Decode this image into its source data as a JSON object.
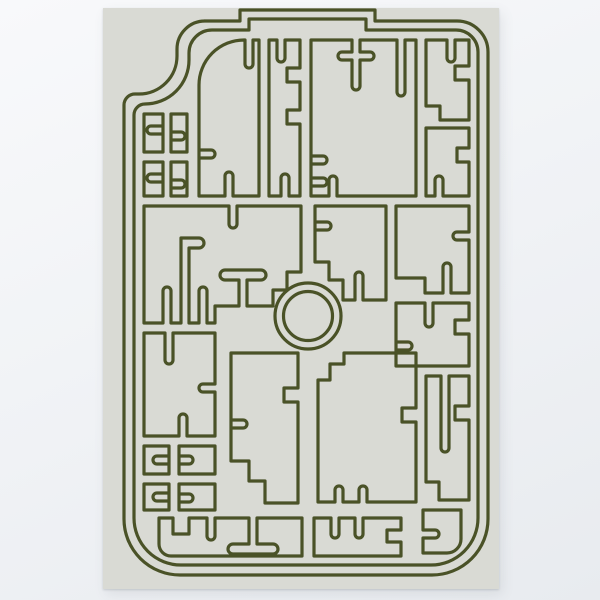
{
  "scene": {
    "wall_color_top": "#f8f9fb",
    "wall_color_bottom": "#e8ebef",
    "poster_background": "#d9dad4"
  },
  "artwork": {
    "stroke_color": "#4a5227",
    "stroke_width": 3.2,
    "viewbox": "0 0 396 581",
    "ring": {
      "cx": 205,
      "cy": 308,
      "outer_r": 33,
      "inner_r": 24.5
    },
    "paths": [
      {
        "name": "outer-frame-outline",
        "d": "M 101,13 H 137 V 2 H 272 V 13 H 354 A 31 31 0 0 1 385,44 V 511 A 56 56 0 0 1 329,567 H 77 A 56 56 0 0 1 21,511 V 97 A 11 11 0 0 1 32,86 H 36 A 38 38 0 0 0 74,48 V 41 A 28 28 0 0 1 102,13 Z"
      },
      {
        "name": "inner-frame-outline",
        "d": "M 109,22 H 146 V 11 H 263 V 22 H 353 A 22 22 0 0 1 375,44 V 510 A 47 47 0 0 1 328,557 H 78 A 47 47 0 0 1 31,510 V 107 A 11 11 0 0 1 42,96 A 44 44 0 0 0 86,52 V 45 A 23 23 0 0 1 109,22 Z"
      },
      {
        "name": "cell-arch-top-left",
        "d": "M 96,188 V 77 A 45 45 0 0 1 141,32 H 142 V 56 A 4 4 0 0 0 150,56 V 32 H 156 V 188 H 130 V 168 A 4 4 0 0 0 122,168 V 188 Z M 96,150 H 108 A 4 4 0 0 0 108,142 H 96"
      },
      {
        "name": "cell-zigzag-column",
        "d": "M 166,32 H 174 V 50 A 4 4 0 0 0 182,50 V 32 H 197 V 60 H 184 V 74 H 197 V 102 H 184 V 116 H 197 V 188 H 186 V 170 A 4 4 0 0 0 178,170 V 188 H 166 Z"
      },
      {
        "name": "cell-top-large",
        "d": "M 208,32 H 249 V 44 H 239 A 4 4 0 0 0 239,52 H 249 V 78 A 4 4 0 0 0 257,78 V 52 H 267 A 4 4 0 0 0 267,44 H 257 V 32 H 294 V 84 A 4 4 0 0 0 302,84 V 32 H 313 V 188 H 234 V 172 A 4 4 0 0 0 226,172 V 188 H 208 Z M 208,178 H 220 A 4 4 0 0 0 220,170 H 208 M 208,156 H 220 A 4 4 0 0 0 220,148 H 208"
      },
      {
        "name": "cell-top-right-upper",
        "d": "M 323,32 H 344 V 50 A 4 4 0 0 0 352,50 V 32 H 366 V 58 H 352 V 72 H 366 V 112 H 337 V 98 H 323 Z"
      },
      {
        "name": "cell-top-right-lower",
        "d": "M 323,120 H 366 V 140 H 354 V 154 H 366 V 188 H 340 V 172 A 4 4 0 0 0 332,172 V 188 H 323 Z"
      },
      {
        "name": "cell-shoulder-a",
        "d": "M 41,106 H 60 V 144 H 41 Z M 60,118 H 48 A 4 4 0 0 0 48,126 H 60"
      },
      {
        "name": "cell-shoulder-b",
        "d": "M 68,106 H 84 V 144 H 68 Z M 68,132 H 78 A 4 4 0 0 0 78,124 H 68"
      },
      {
        "name": "cell-shoulder-c",
        "d": "M 41,154 H 60 V 188 H 41 Z M 60,166 H 48 A 4 4 0 0 0 48,174 H 60"
      },
      {
        "name": "cell-shoulder-d",
        "d": "M 68,154 H 84 V 188 H 68 Z M 68,180 H 78 A 4 4 0 0 0 78,172 H 68"
      },
      {
        "name": "cell-mid-left-flag-table",
        "d": "M 41,198 H 126 V 216 A 4 4 0 0 0 134,216 V 198 H 198 V 264 H 184 V 282 H 170 V 298 H 144 V 272 H 158 A 5 5 0 0 0 158,262 H 122 A 5 5 0 0 0 122,272 H 136 V 298 H 112 V 315 H 104 V 283 A 4 4 0 0 0 96,283 V 315 H 86 V 240 H 96 A 5 5 0 0 0 96,230 H 78 V 315 H 68 V 283 A 4 4 0 0 0 60,283 V 315 H 41 Z"
      },
      {
        "name": "cell-mid-left-lower",
        "d": "M 41,325 H 62 V 352 A 4 4 0 0 0 70,352 V 325 H 112 V 376 H 100 A 4 4 0 0 0 100,384 H 112 V 428 H 84 V 410 A 4 4 0 0 0 76,410 V 428 H 41 Z"
      },
      {
        "name": "cell-mid-right-of-center",
        "d": "M 212,198 H 283 V 292 H 260 V 268 A 4 4 0 0 0 252,268 V 292 H 240 V 272 H 226 V 254 H 212 Z M 212,222 H 224 A 4 4 0 0 0 224,214 H 212"
      },
      {
        "name": "cell-right-upper",
        "d": "M 293,198 H 366 V 224 H 354 A 4 4 0 0 0 354,232 H 366 V 285 H 348 V 259 A 4 4 0 0 0 340,259 V 285 H 322 V 270 H 293 Z"
      },
      {
        "name": "cell-right-middle",
        "d": "M 293,295 H 322 V 315 A 4 4 0 0 0 330,315 V 295 H 366 V 312 H 352 V 326 H 366 V 358 H 293 Z M 293,342 H 305 A 4 4 0 0 0 305,334 H 293"
      },
      {
        "name": "cell-lower-center-large",
        "d": "M 215,372 H 227 V 356 H 241 V 345 H 313 V 400 H 299 V 414 H 313 V 494 H 264 V 482 A 4 4 0 0 0 256,482 V 494 H 240 V 482 A 4 4 0 0 0 232,482 V 494 H 215 Z"
      },
      {
        "name": "cell-lower-left-tall",
        "d": "M 128,345 H 195 V 380 H 181 V 394 H 195 V 495 H 162 V 473 H 146 V 453 H 128 Z M 128,420 H 140 A 4 4 0 0 0 140,412 H 128"
      },
      {
        "name": "cell-grid-a",
        "d": "M 41,438 H 66 V 466 H 41 Z M 66,448 H 54 A 4 4 0 0 0 54,456 H 66"
      },
      {
        "name": "cell-grid-b",
        "d": "M 76,438 H 112 V 466 H 76 Z M 76,456 H 86 A 4 4 0 0 0 86,448 H 76"
      },
      {
        "name": "cell-grid-c",
        "d": "M 41,476 H 66 V 502 H 41 Z M 66,485 H 54 A 4 4 0 0 0 54,493 H 66"
      },
      {
        "name": "cell-grid-d",
        "d": "M 76,476 H 112 V 502 H 76 Z M 76,494 H 86 A 4 4 0 0 0 86,486 H 76"
      },
      {
        "name": "cell-lower-right-spike",
        "d": "M 323,368 H 338 V 440 A 4 4 0 0 0 346,440 V 368 H 366 V 398 H 352 V 412 H 366 V 492 H 336 V 474 H 323 Z"
      },
      {
        "name": "cell-bottom-left-pedestal",
        "d": "M 56,510 H 70 V 526 H 86 V 510 H 104 V 528 A 4 4 0 0 0 112,528 V 510 H 146 V 536 H 130 A 5 5 0 0 0 130,546 H 170 A 5 5 0 0 0 170,536 H 154 V 510 H 199 V 548 H 68 A 12 12 0 0 1 56,536 Z"
      },
      {
        "name": "cell-bottom-center-spikes",
        "d": "M 211,510 H 228 V 526 A 4 4 0 0 0 236,526 V 510 H 252 V 526 A 4 4 0 0 0 260,526 V 510 H 298 V 522 H 284 V 534 H 298 V 548 H 211 Z"
      },
      {
        "name": "cell-bottom-right-hook",
        "d": "M 320,502 H 358 V 531 A 14 14 0 0 1 344,545 H 320 V 530 H 332 A 4 4 0 0 0 332,522 H 320 Z"
      }
    ]
  }
}
